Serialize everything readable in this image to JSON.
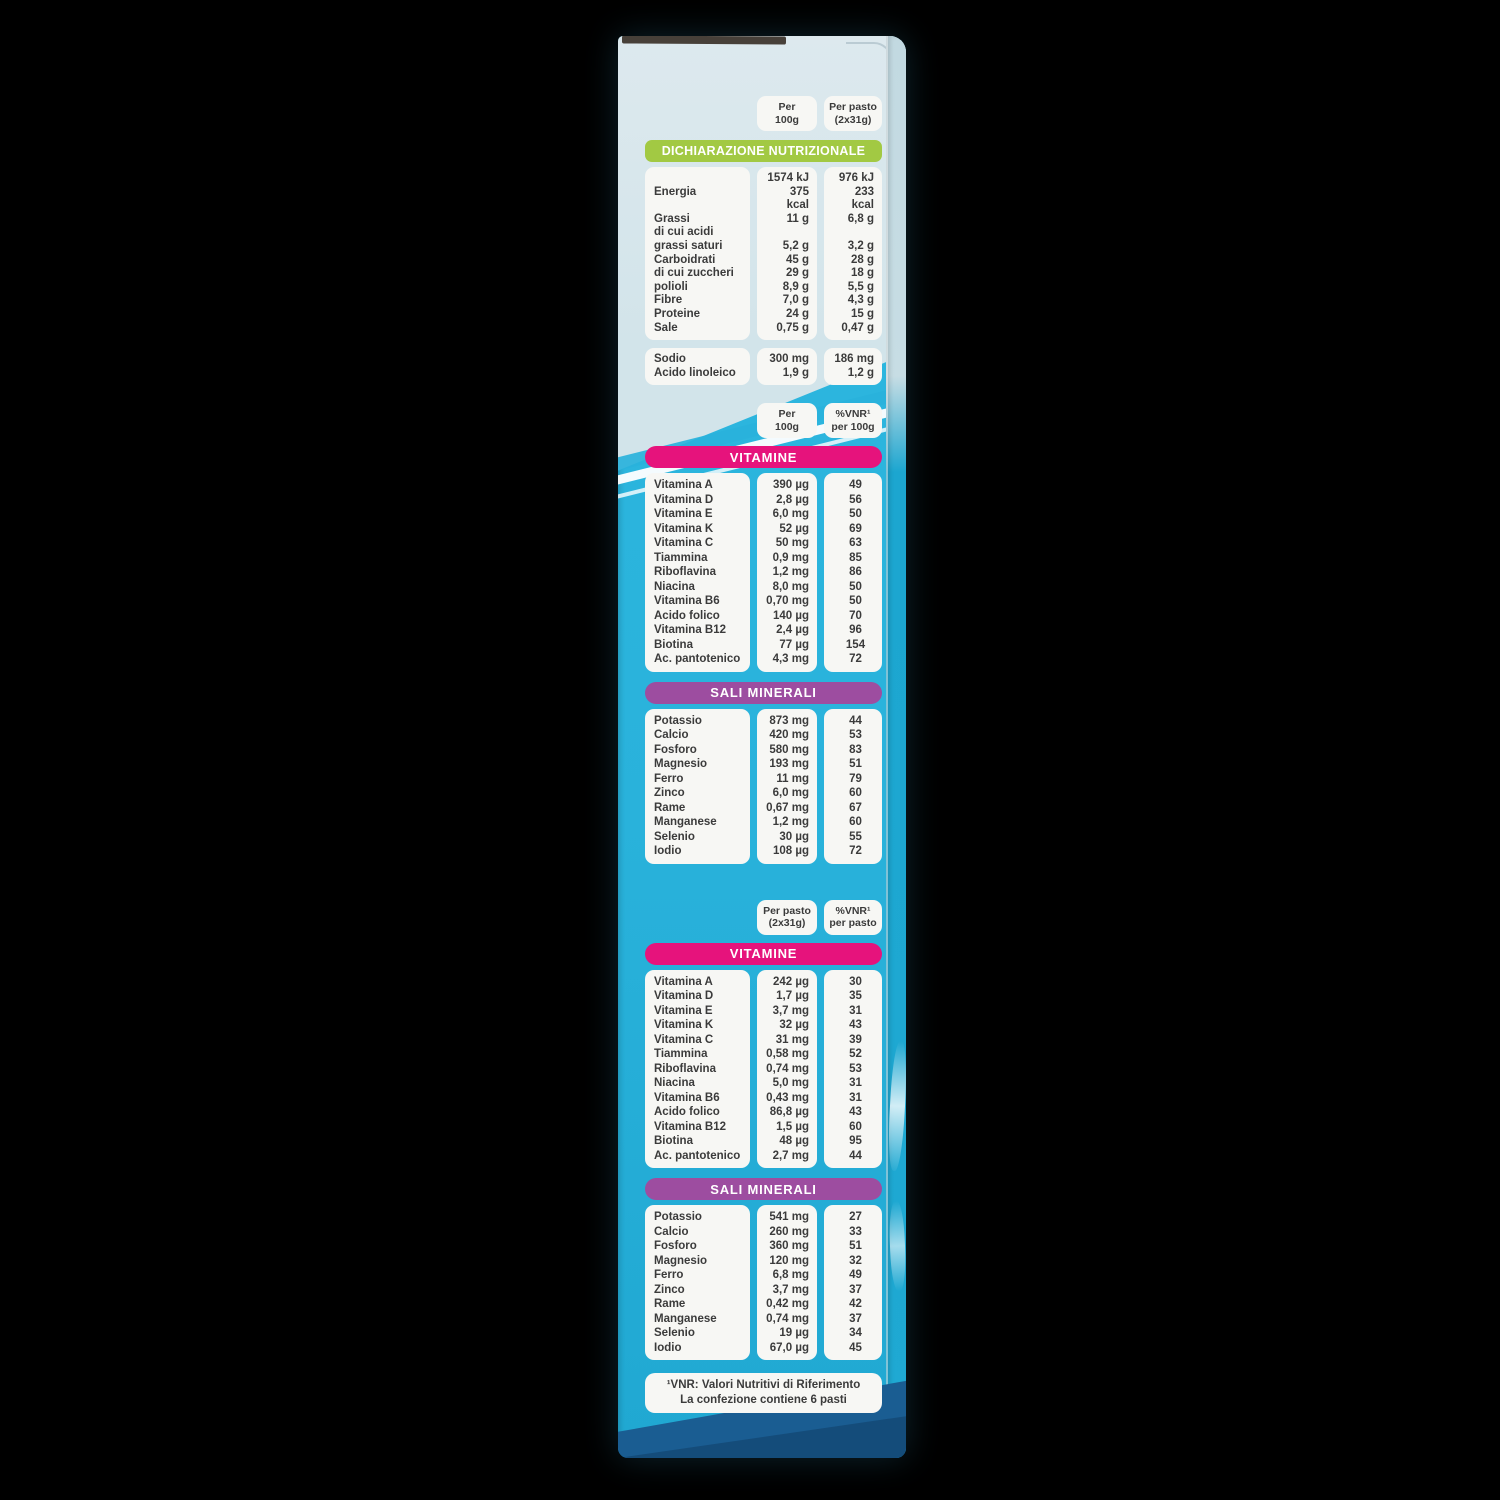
{
  "colors": {
    "bg": "#000000",
    "panel_light": "#d2e4ea",
    "panel_cyan": "#29b2db",
    "flap_navy": "#1a5d92",
    "banner_green": "#a2c943",
    "banner_pink": "#e6137c",
    "banner_purple": "#9d4da0",
    "card": "#f7f7f4",
    "ink": "#3b3b3b"
  },
  "nutrition_declaration": {
    "column_headers": {
      "per_100g": [
        "Per",
        "100g"
      ],
      "per_pasto": [
        "Per pasto",
        "(2x31g)"
      ]
    },
    "banner": "DICHIARAZIONE NUTRIZIONALE",
    "rows": [
      {
        "label": [
          "Energia"
        ],
        "per_100g": [
          "1574 kJ",
          "375 kcal"
        ],
        "per_pasto": [
          "976 kJ",
          "233 kcal"
        ]
      },
      {
        "label": [
          "Grassi"
        ],
        "per_100g": [
          "11 g"
        ],
        "per_pasto": [
          "6,8 g"
        ]
      },
      {
        "label": [
          "di cui acidi",
          "grassi saturi"
        ],
        "per_100g": [
          "5,2 g"
        ],
        "per_pasto": [
          "3,2 g"
        ]
      },
      {
        "label": [
          "Carboidrati"
        ],
        "per_100g": [
          "45 g"
        ],
        "per_pasto": [
          "28 g"
        ]
      },
      {
        "label": [
          "di cui zuccheri"
        ],
        "per_100g": [
          "29 g"
        ],
        "per_pasto": [
          "18 g"
        ]
      },
      {
        "label": [
          "polioli"
        ],
        "per_100g": [
          "8,9 g"
        ],
        "per_pasto": [
          "5,5 g"
        ]
      },
      {
        "label": [
          "Fibre"
        ],
        "per_100g": [
          "7,0 g"
        ],
        "per_pasto": [
          "4,3 g"
        ]
      },
      {
        "label": [
          "Proteine"
        ],
        "per_100g": [
          "24 g"
        ],
        "per_pasto": [
          "15 g"
        ]
      },
      {
        "label": [
          "Sale"
        ],
        "per_100g": [
          "0,75 g"
        ],
        "per_pasto": [
          "0,47 g"
        ]
      }
    ],
    "extra_rows": [
      {
        "label": [
          "Sodio"
        ],
        "per_100g": [
          "300 mg"
        ],
        "per_pasto": [
          "186 mg"
        ]
      },
      {
        "label": [
          "Acido linoleico"
        ],
        "per_100g": [
          "1,9 g"
        ],
        "per_pasto": [
          "1,2 g"
        ]
      }
    ]
  },
  "per_100g": {
    "column_headers": {
      "amount": [
        "Per",
        "100g"
      ],
      "vnr": [
        "%VNR¹",
        "per 100g"
      ]
    },
    "vitamins_banner": "VITAMINE",
    "vitamins": [
      {
        "label": [
          "Vitamina A"
        ],
        "amount": [
          "390 µg"
        ],
        "vnr": [
          "49"
        ]
      },
      {
        "label": [
          "Vitamina D"
        ],
        "amount": [
          "2,8 µg"
        ],
        "vnr": [
          "56"
        ]
      },
      {
        "label": [
          "Vitamina E"
        ],
        "amount": [
          "6,0 mg"
        ],
        "vnr": [
          "50"
        ]
      },
      {
        "label": [
          "Vitamina K"
        ],
        "amount": [
          "52 µg"
        ],
        "vnr": [
          "69"
        ]
      },
      {
        "label": [
          "Vitamina C"
        ],
        "amount": [
          "50 mg"
        ],
        "vnr": [
          "63"
        ]
      },
      {
        "label": [
          "Tiammina"
        ],
        "amount": [
          "0,9 mg"
        ],
        "vnr": [
          "85"
        ]
      },
      {
        "label": [
          "Riboflavina"
        ],
        "amount": [
          "1,2 mg"
        ],
        "vnr": [
          "86"
        ]
      },
      {
        "label": [
          "Niacina"
        ],
        "amount": [
          "8,0 mg"
        ],
        "vnr": [
          "50"
        ]
      },
      {
        "label": [
          "Vitamina B6"
        ],
        "amount": [
          "0,70 mg"
        ],
        "vnr": [
          "50"
        ]
      },
      {
        "label": [
          "Acido folico"
        ],
        "amount": [
          "140 µg"
        ],
        "vnr": [
          "70"
        ]
      },
      {
        "label": [
          "Vitamina B12"
        ],
        "amount": [
          "2,4 µg"
        ],
        "vnr": [
          "96"
        ]
      },
      {
        "label": [
          "Biotina"
        ],
        "amount": [
          "77 µg"
        ],
        "vnr": [
          "154"
        ]
      },
      {
        "label": [
          "Ac. pantotenico"
        ],
        "amount": [
          "4,3 mg"
        ],
        "vnr": [
          "72"
        ]
      }
    ],
    "minerals_banner": "SALI MINERALI",
    "minerals": [
      {
        "label": [
          "Potassio"
        ],
        "amount": [
          "873 mg"
        ],
        "vnr": [
          "44"
        ]
      },
      {
        "label": [
          "Calcio"
        ],
        "amount": [
          "420 mg"
        ],
        "vnr": [
          "53"
        ]
      },
      {
        "label": [
          "Fosforo"
        ],
        "amount": [
          "580 mg"
        ],
        "vnr": [
          "83"
        ]
      },
      {
        "label": [
          "Magnesio"
        ],
        "amount": [
          "193 mg"
        ],
        "vnr": [
          "51"
        ]
      },
      {
        "label": [
          "Ferro"
        ],
        "amount": [
          "11 mg"
        ],
        "vnr": [
          "79"
        ]
      },
      {
        "label": [
          "Zinco"
        ],
        "amount": [
          "6,0 mg"
        ],
        "vnr": [
          "60"
        ]
      },
      {
        "label": [
          "Rame"
        ],
        "amount": [
          "0,67 mg"
        ],
        "vnr": [
          "67"
        ]
      },
      {
        "label": [
          "Manganese"
        ],
        "amount": [
          "1,2 mg"
        ],
        "vnr": [
          "60"
        ]
      },
      {
        "label": [
          "Selenio"
        ],
        "amount": [
          "30 µg"
        ],
        "vnr": [
          "55"
        ]
      },
      {
        "label": [
          "Iodio"
        ],
        "amount": [
          "108 µg"
        ],
        "vnr": [
          "72"
        ]
      }
    ]
  },
  "per_pasto": {
    "column_headers": {
      "amount": [
        "Per pasto",
        "(2x31g)"
      ],
      "vnr": [
        "%VNR¹",
        "per pasto"
      ]
    },
    "vitamins_banner": "VITAMINE",
    "vitamins": [
      {
        "label": [
          "Vitamina A"
        ],
        "amount": [
          "242 µg"
        ],
        "vnr": [
          "30"
        ]
      },
      {
        "label": [
          "Vitamina D"
        ],
        "amount": [
          "1,7 µg"
        ],
        "vnr": [
          "35"
        ]
      },
      {
        "label": [
          "Vitamina E"
        ],
        "amount": [
          "3,7 mg"
        ],
        "vnr": [
          "31"
        ]
      },
      {
        "label": [
          "Vitamina K"
        ],
        "amount": [
          "32 µg"
        ],
        "vnr": [
          "43"
        ]
      },
      {
        "label": [
          "Vitamina C"
        ],
        "amount": [
          "31 mg"
        ],
        "vnr": [
          "39"
        ]
      },
      {
        "label": [
          "Tiammina"
        ],
        "amount": [
          "0,58 mg"
        ],
        "vnr": [
          "52"
        ]
      },
      {
        "label": [
          "Riboflavina"
        ],
        "amount": [
          "0,74 mg"
        ],
        "vnr": [
          "53"
        ]
      },
      {
        "label": [
          "Niacina"
        ],
        "amount": [
          "5,0 mg"
        ],
        "vnr": [
          "31"
        ]
      },
      {
        "label": [
          "Vitamina B6"
        ],
        "amount": [
          "0,43 mg"
        ],
        "vnr": [
          "31"
        ]
      },
      {
        "label": [
          "Acido folico"
        ],
        "amount": [
          "86,8 µg"
        ],
        "vnr": [
          "43"
        ]
      },
      {
        "label": [
          "Vitamina B12"
        ],
        "amount": [
          "1,5 µg"
        ],
        "vnr": [
          "60"
        ]
      },
      {
        "label": [
          "Biotina"
        ],
        "amount": [
          "48 µg"
        ],
        "vnr": [
          "95"
        ]
      },
      {
        "label": [
          "Ac. pantotenico"
        ],
        "amount": [
          "2,7 mg"
        ],
        "vnr": [
          "44"
        ]
      }
    ],
    "minerals_banner": "SALI MINERALI",
    "minerals": [
      {
        "label": [
          "Potassio"
        ],
        "amount": [
          "541 mg"
        ],
        "vnr": [
          "27"
        ]
      },
      {
        "label": [
          "Calcio"
        ],
        "amount": [
          "260 mg"
        ],
        "vnr": [
          "33"
        ]
      },
      {
        "label": [
          "Fosforo"
        ],
        "amount": [
          "360 mg"
        ],
        "vnr": [
          "51"
        ]
      },
      {
        "label": [
          "Magnesio"
        ],
        "amount": [
          "120 mg"
        ],
        "vnr": [
          "32"
        ]
      },
      {
        "label": [
          "Ferro"
        ],
        "amount": [
          "6,8 mg"
        ],
        "vnr": [
          "49"
        ]
      },
      {
        "label": [
          "Zinco"
        ],
        "amount": [
          "3,7 mg"
        ],
        "vnr": [
          "37"
        ]
      },
      {
        "label": [
          "Rame"
        ],
        "amount": [
          "0,42 mg"
        ],
        "vnr": [
          "42"
        ]
      },
      {
        "label": [
          "Manganese"
        ],
        "amount": [
          "0,74 mg"
        ],
        "vnr": [
          "37"
        ]
      },
      {
        "label": [
          "Selenio"
        ],
        "amount": [
          "19 µg"
        ],
        "vnr": [
          "34"
        ]
      },
      {
        "label": [
          "Iodio"
        ],
        "amount": [
          "67,0 µg"
        ],
        "vnr": [
          "45"
        ]
      }
    ]
  },
  "footnote": {
    "line1": "¹VNR: Valori Nutritivi di Riferimento",
    "line2": "La confezione contiene 6 pasti"
  }
}
